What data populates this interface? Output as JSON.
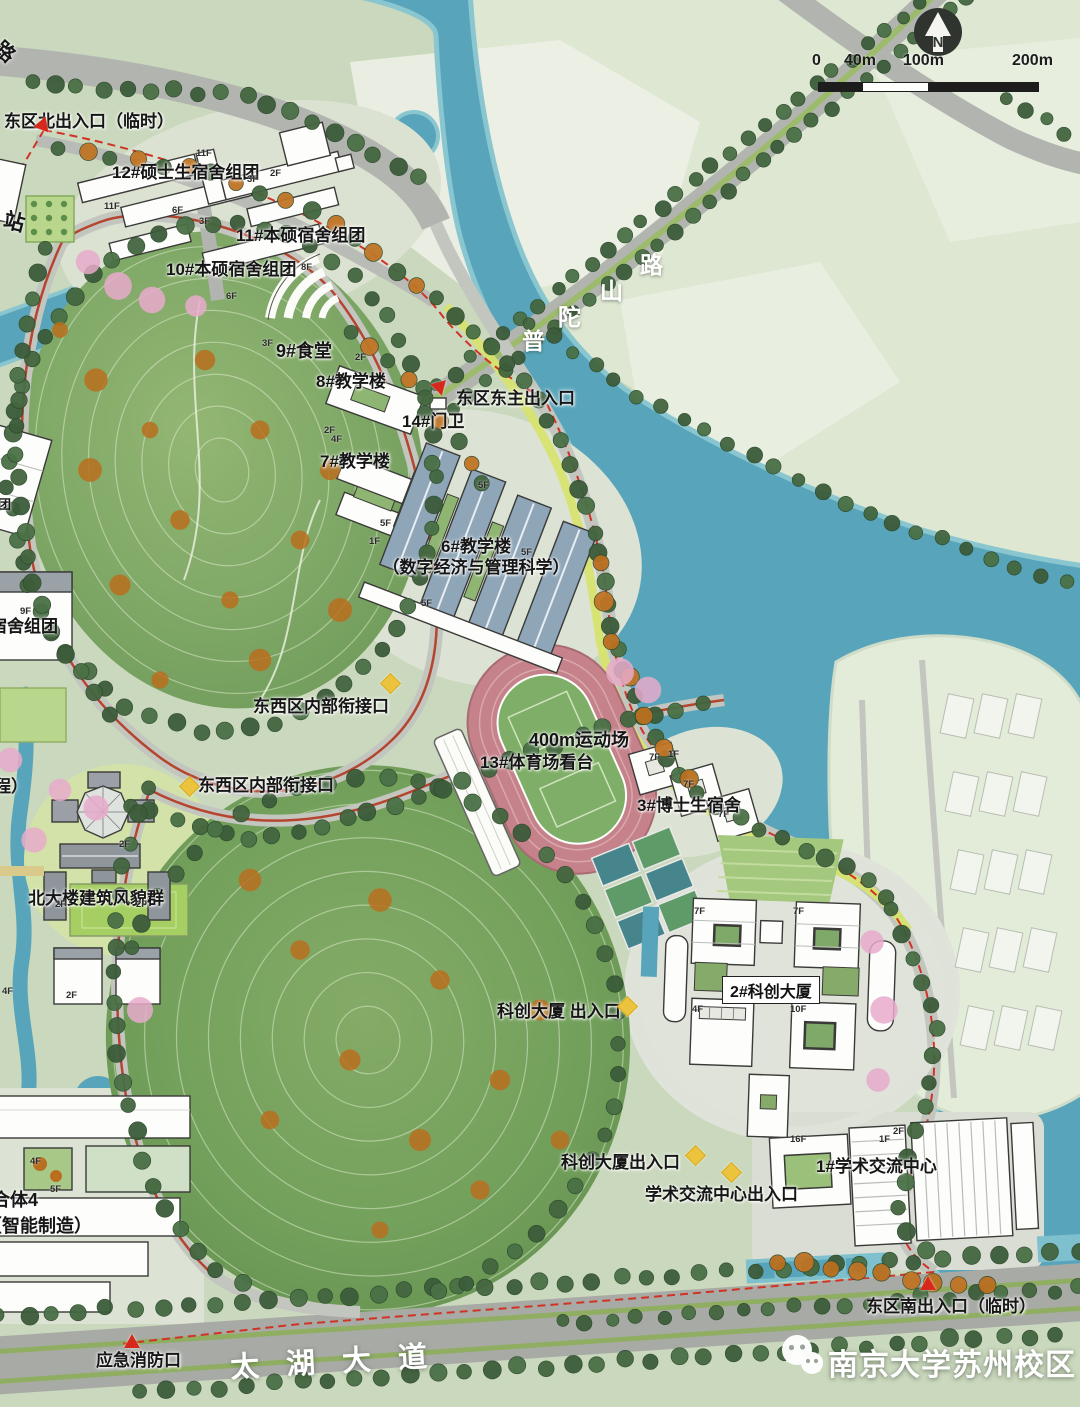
{
  "meta": {
    "campus_watermark": "南京大学苏州校区",
    "compass": "N"
  },
  "scale_bar": {
    "ticks": [
      "0",
      "40m",
      "100m",
      "200m"
    ]
  },
  "roads": {
    "taihu": "太湖大道",
    "putuo": "普陀山路"
  },
  "entrances": {
    "north": "东区北出入口（临时）",
    "east_main": "东区东主出入口",
    "south": "东区南出入口（临时）",
    "fire": "应急消防口",
    "connector_a": "东西区内部衔接口",
    "connector_b": "东西区内部衔接口",
    "kechuang_a": "科创大厦 出入口",
    "kechuang_b": "科创大厦出入口",
    "xueshu": "学术交流中心出入口"
  },
  "buildings": {
    "b12": "12#硕士生宿舍组团",
    "b11": "11#本硕宿舍组团",
    "b10": "10#本硕宿舍组团",
    "b9": "9#食堂",
    "b8": "8#教学楼",
    "b14": "14#门卫",
    "b7": "7#教学楼",
    "b6_line1": "6#教学楼",
    "b6_line2": "（数字经济与管理科学）",
    "track": "400m运动场",
    "stand": "13#体育场看台",
    "b3": "3#博士生宿舍",
    "north_heritage": "北大楼建筑风貌群",
    "b2": "2#科创大厦",
    "b1": "1#学术交流中心"
  },
  "partial_labels": {
    "road_char": "路",
    "station": "站",
    "dorm_group": "宿舍组团",
    "cheng": "程）",
    "heti4": "合体4",
    "heti4_sub": "（智能制造）",
    "tuan": "团"
  },
  "floor_tags": [
    {
      "t": "11F",
      "x": 196,
      "y": 148
    },
    {
      "t": "2F",
      "x": 270,
      "y": 168
    },
    {
      "t": "3F",
      "x": 247,
      "y": 174
    },
    {
      "t": "11F",
      "x": 104,
      "y": 201
    },
    {
      "t": "6F",
      "x": 172,
      "y": 205
    },
    {
      "t": "3F",
      "x": 199,
      "y": 216
    },
    {
      "t": "8F",
      "x": 301,
      "y": 262
    },
    {
      "t": "6F",
      "x": 226,
      "y": 291
    },
    {
      "t": "3F",
      "x": 262,
      "y": 338
    },
    {
      "t": "2F",
      "x": 355,
      "y": 352
    },
    {
      "t": "2F",
      "x": 324,
      "y": 425
    },
    {
      "t": "4F",
      "x": 331,
      "y": 434
    },
    {
      "t": "5F",
      "x": 478,
      "y": 480
    },
    {
      "t": "5F",
      "x": 380,
      "y": 518
    },
    {
      "t": "1F",
      "x": 369,
      "y": 536
    },
    {
      "t": "5F",
      "x": 421,
      "y": 598
    },
    {
      "t": "5F",
      "x": 521,
      "y": 547
    },
    {
      "t": "9F",
      "x": 20,
      "y": 606
    },
    {
      "t": "7F",
      "x": 649,
      "y": 752
    },
    {
      "t": "1F",
      "x": 668,
      "y": 749
    },
    {
      "t": "7F",
      "x": 683,
      "y": 779
    },
    {
      "t": "7F",
      "x": 718,
      "y": 809
    },
    {
      "t": "7F",
      "x": 694,
      "y": 906
    },
    {
      "t": "7F",
      "x": 793,
      "y": 906
    },
    {
      "t": "4F",
      "x": 692,
      "y": 1004
    },
    {
      "t": "10F",
      "x": 790,
      "y": 1004
    },
    {
      "t": "16F",
      "x": 790,
      "y": 1134
    },
    {
      "t": "2F",
      "x": 893,
      "y": 1126
    },
    {
      "t": "1F",
      "x": 879,
      "y": 1134
    },
    {
      "t": "2F",
      "x": 119,
      "y": 839
    },
    {
      "t": "2F",
      "x": 55,
      "y": 899
    },
    {
      "t": "2F",
      "x": 136,
      "y": 899
    },
    {
      "t": "4F",
      "x": 30,
      "y": 1156
    },
    {
      "t": "5F",
      "x": 50,
      "y": 1184
    },
    {
      "t": "4F",
      "x": 2,
      "y": 986
    },
    {
      "t": "2F",
      "x": 66,
      "y": 990
    }
  ]
}
